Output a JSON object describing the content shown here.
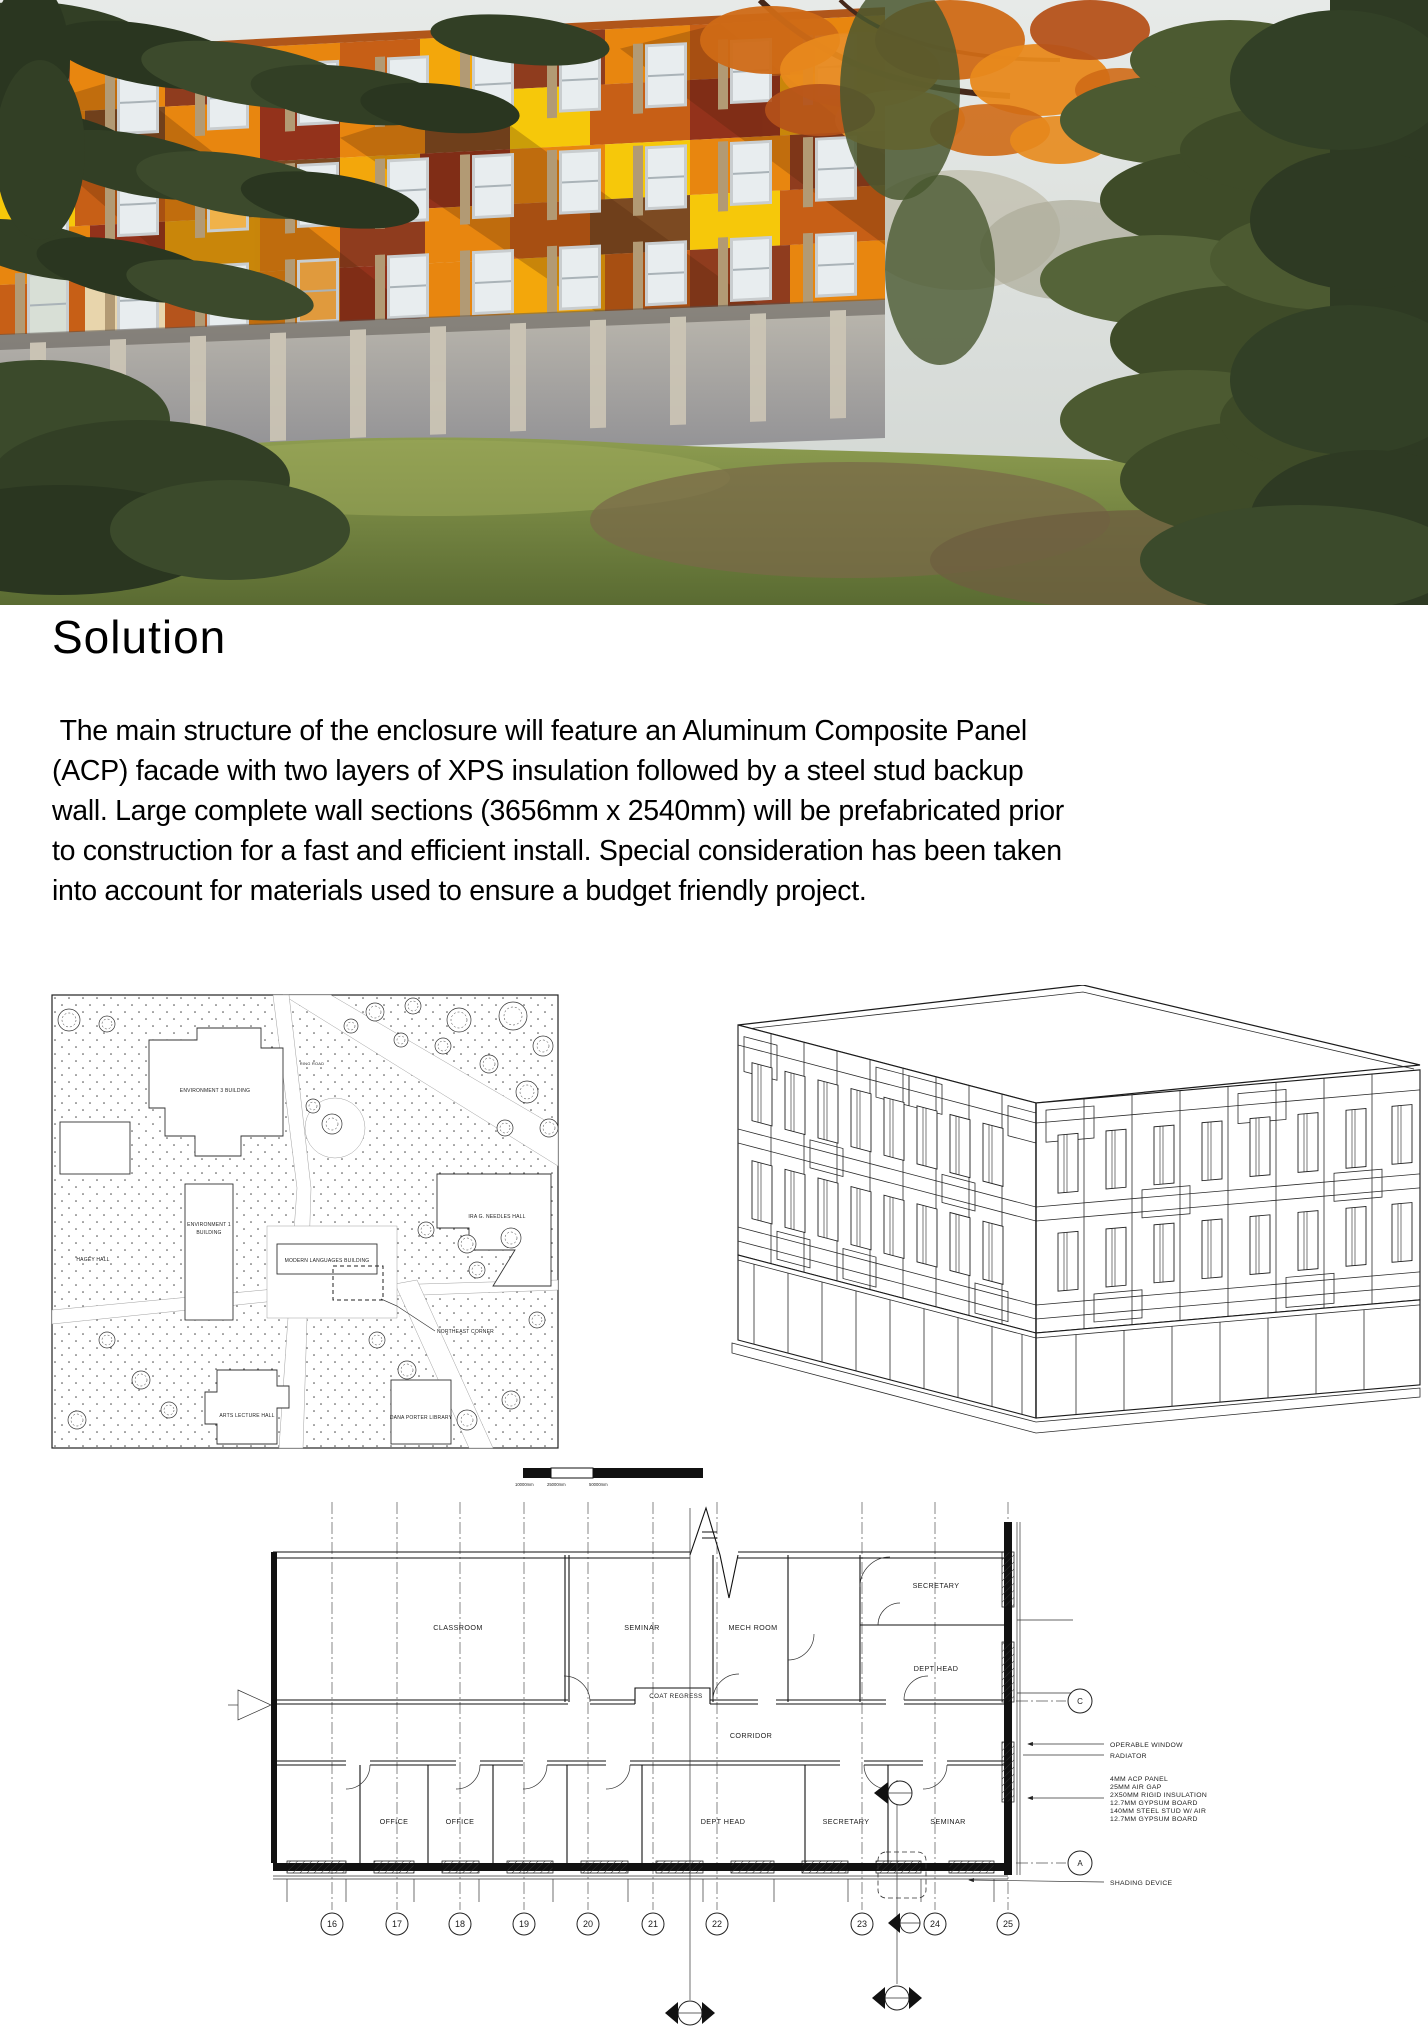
{
  "document": {
    "heading": "Solution",
    "body": " The main structure of the enclosure will feature an Aluminum Composite Panel (ACP) facade with two layers of XPS insulation followed by a steel stud backup wall. Large complete wall sections (3656mm x 2540mm) will be prefabricated prior to construction for a fast and efficient install. Special consideration has been taken into account for materials used to ensure a budget friendly project."
  },
  "hero": {
    "palette": {
      "orange": "#e8860f",
      "dark_orange": "#c75f16",
      "rust": "#b5541c",
      "maroon": "#93321b",
      "dark_red": "#8f3c1e",
      "brown": "#7c4a22",
      "yellow": "#f6c80a",
      "amber": "#f3a70b",
      "cream": "#e8d5ac",
      "fin_tan": "#b29a74",
      "concrete": "#a3a3a6",
      "grass": "#7d8d47",
      "foliage": "#35422a"
    }
  },
  "site_plan": {
    "labels": {
      "env3": "ENVIRONMENT 3 BUILDING",
      "ring_road": "RING ROAD",
      "env1_line1": "ENVIRONMENT 1",
      "env1_line2": "BUILDING",
      "hagey": "HAGEY HALL",
      "modern_languages": "MODERN LANGUAGES BUILDING",
      "northeast_corner": "NORTHEAST CORNER",
      "ira_needles": "IRA G. NEEDLES HALL",
      "arts_lecture": "ARTS LECTURE HALL",
      "dana_porter": "DANA PORTER LIBRARY"
    },
    "scale_labels": [
      "10000mm",
      "25000mm",
      "50000mm"
    ]
  },
  "floor_plan": {
    "rooms": {
      "classroom": "CLASSROOM",
      "seminar_top": "SEMINAR",
      "mech_room": "MECH ROOM",
      "coat_regress": "COAT REGRESS",
      "corridor": "CORRIDOR",
      "secretary_top": "SECRETARY",
      "dept_head_top": "DEPT HEAD",
      "office_1": "OFFICE",
      "office_2": "OFFICE",
      "dept_head_bottom": "DEPT HEAD",
      "secretary_bottom": "SECRETARY",
      "seminar_bottom": "SEMINAR"
    },
    "grid_bubbles": [
      "16",
      "17",
      "18",
      "19",
      "20",
      "21",
      "22",
      "23",
      "24",
      "25"
    ],
    "ref_bubbles": {
      "c": "C",
      "a": "A"
    },
    "annotations": {
      "operable_window": "OPERABLE WINDOW",
      "radiator": "RADIATOR",
      "shading_device": "SHADING DEVICE",
      "wall_assembly": [
        "4MM ACP PANEL",
        "25MM AIR GAP",
        "2X50MM RIGID INSULATION",
        "12.7MM GYPSUM BOARD",
        "140MM STEEL STUD W/ AIR",
        "12.7MM GYPSUM BOARD"
      ]
    }
  }
}
